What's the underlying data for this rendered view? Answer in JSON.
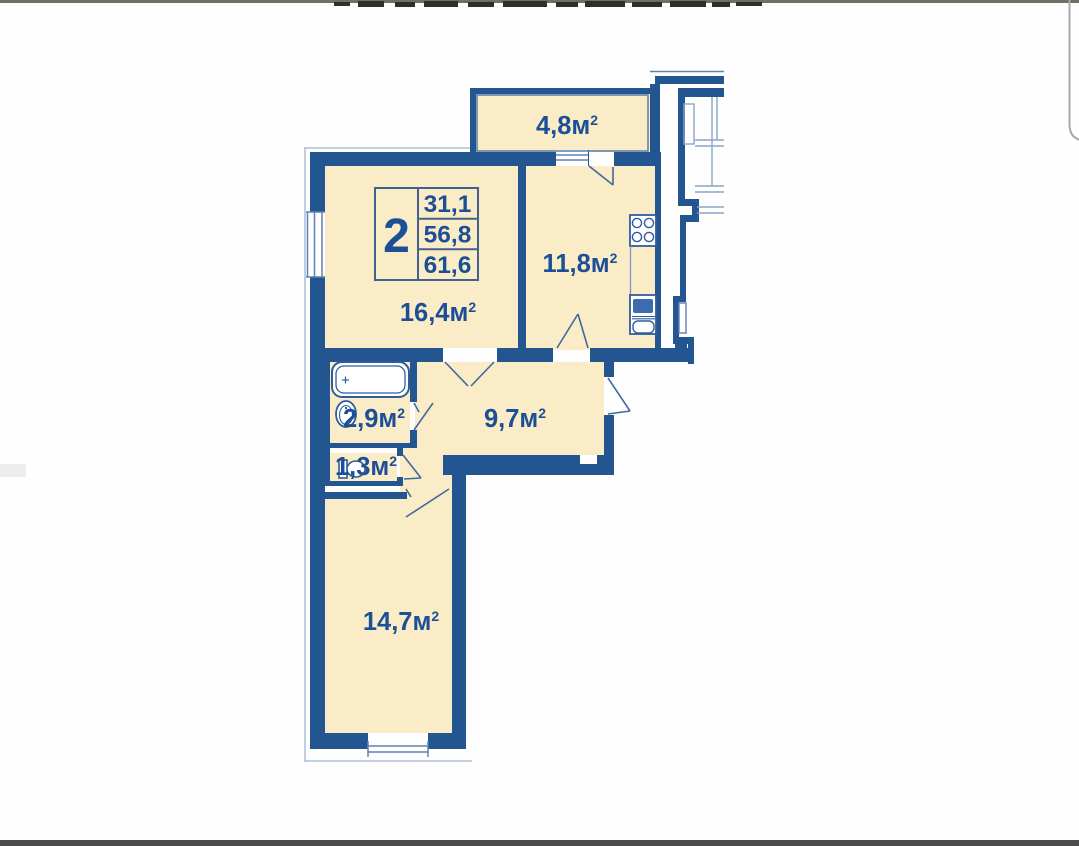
{
  "plan": {
    "legend": {
      "type": "2",
      "values": [
        "31,1",
        "56,8",
        "61,6"
      ]
    },
    "rooms": [
      {
        "name": "balcony",
        "area": "4,8"
      },
      {
        "name": "kitchen",
        "area": "11,8"
      },
      {
        "name": "living-room",
        "area": "16,4"
      },
      {
        "name": "bathroom",
        "area": "2,9"
      },
      {
        "name": "wc",
        "area": "1,3"
      },
      {
        "name": "hallway",
        "area": "9,7"
      },
      {
        "name": "bedroom",
        "area": "14,7"
      }
    ],
    "unit": "м",
    "unit_sup": "2",
    "icons": {
      "bathtub": "bathtub-icon",
      "washbasin": "washbasin-icon",
      "toilet": "toilet-icon",
      "stove": "stove-icon",
      "kitchen_sink": "kitchen-sink-icon"
    },
    "colors": {
      "wall": "#235691",
      "room_fill": "#f9ecc7",
      "label_text": "#1c4f96",
      "thin_line": "#5f82b2",
      "sink_fill": "#3c6cad"
    }
  }
}
